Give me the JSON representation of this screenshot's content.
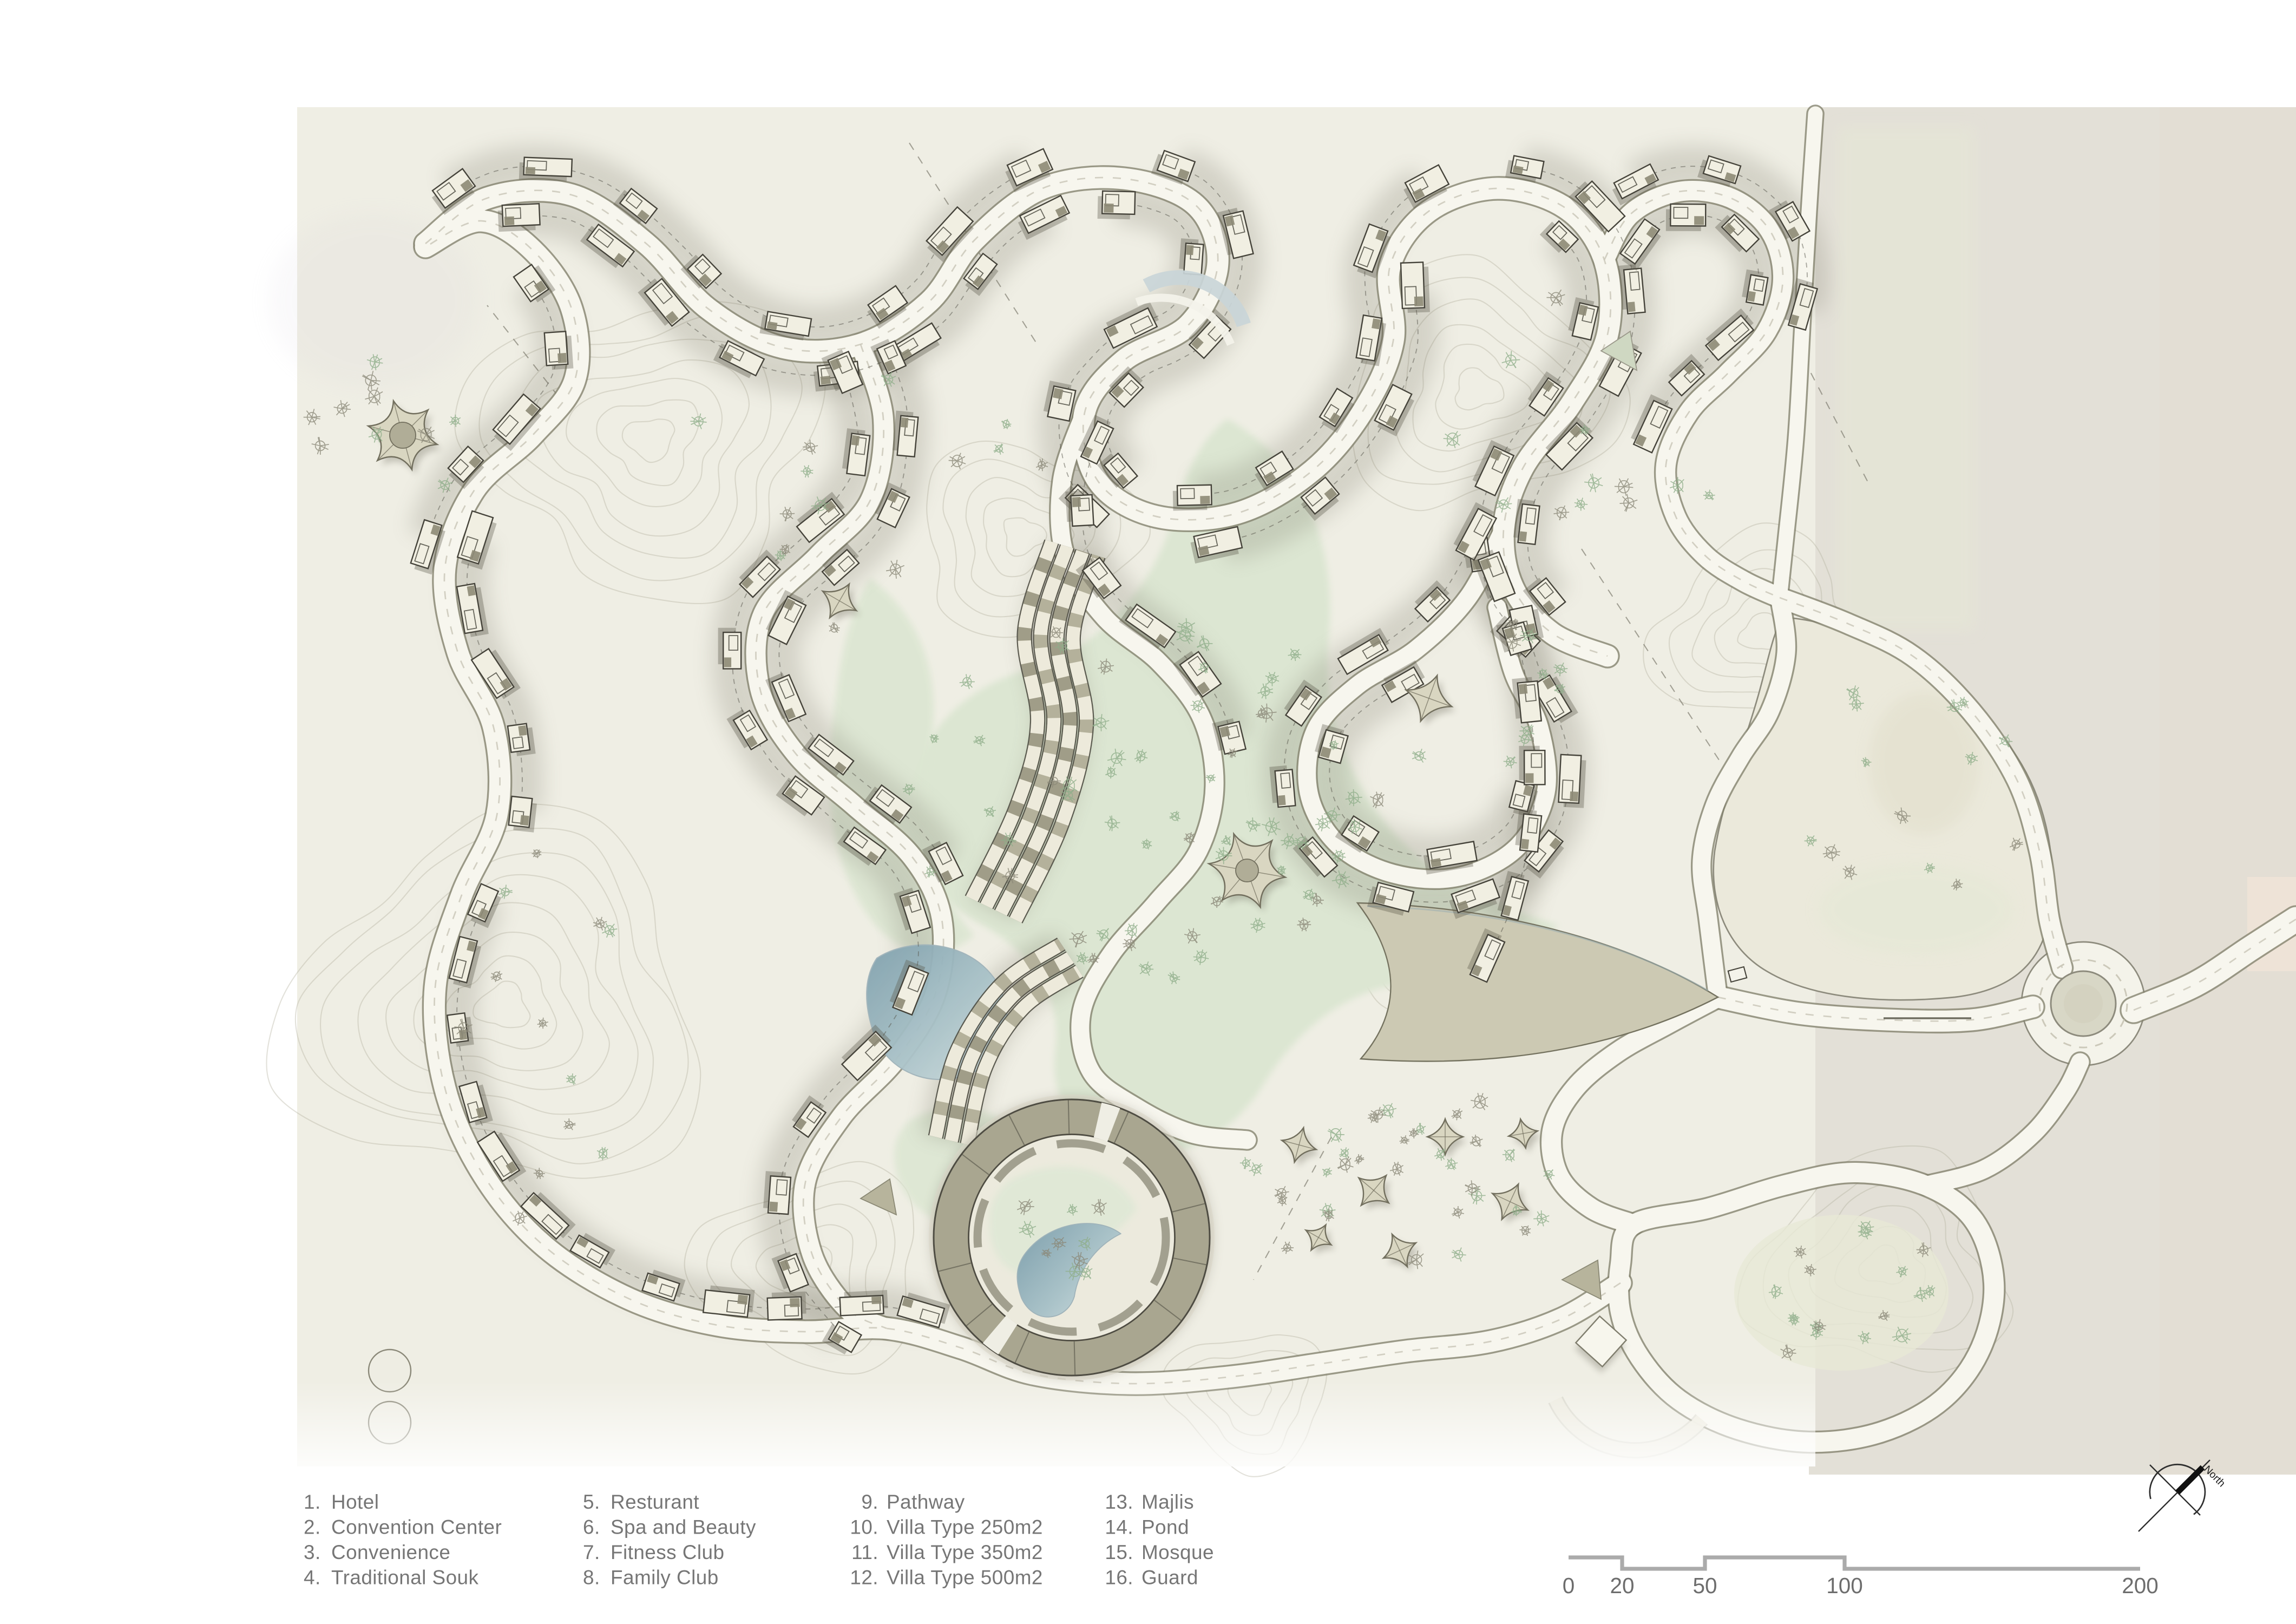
{
  "legend": {
    "items": [
      {
        "num": "1.",
        "label": "Hotel"
      },
      {
        "num": "2.",
        "label": "Convention Center"
      },
      {
        "num": "3.",
        "label": "Convenience"
      },
      {
        "num": "4.",
        "label": "Traditional Souk"
      },
      {
        "num": "5.",
        "label": "Resturant"
      },
      {
        "num": "6.",
        "label": "Spa and Beauty"
      },
      {
        "num": "7.",
        "label": "Fitness Club"
      },
      {
        "num": "8.",
        "label": "Family Club"
      },
      {
        "num": "9.",
        "label": "Pathway"
      },
      {
        "num": "10.",
        "label": "Villa Type 250m2"
      },
      {
        "num": "11.",
        "label": "Villa Type 350m2"
      },
      {
        "num": "12.",
        "label": "Villa Type 500m2"
      },
      {
        "num": "13.",
        "label": "Majlis"
      },
      {
        "num": "14.",
        "label": "Pond"
      },
      {
        "num": "15.",
        "label": "Mosque"
      },
      {
        "num": "16.",
        "label": "Guard"
      }
    ]
  },
  "scalebar": {
    "labels": [
      "0",
      "20",
      "50",
      "100",
      "200"
    ]
  },
  "north": {
    "label": "North"
  },
  "colors": {
    "paper": "#ffffff",
    "sheet_cream": "#efeee4",
    "sheet_beige": "#e3e0d7",
    "contour": "#b3b09f",
    "road_fill": "#f7f6ee",
    "road_casing": "#85836f",
    "green_park": "#dce6d2",
    "pond_deep": "#7fa0ad",
    "pond_light": "#d3e1e2",
    "building_outline": "#45433a",
    "building_fill": "#f1efe2",
    "ring_building": "#a9a690",
    "plaza_khaki": "#ccc9b3",
    "legend_text": "#767676",
    "scale_line": "#ababab"
  }
}
